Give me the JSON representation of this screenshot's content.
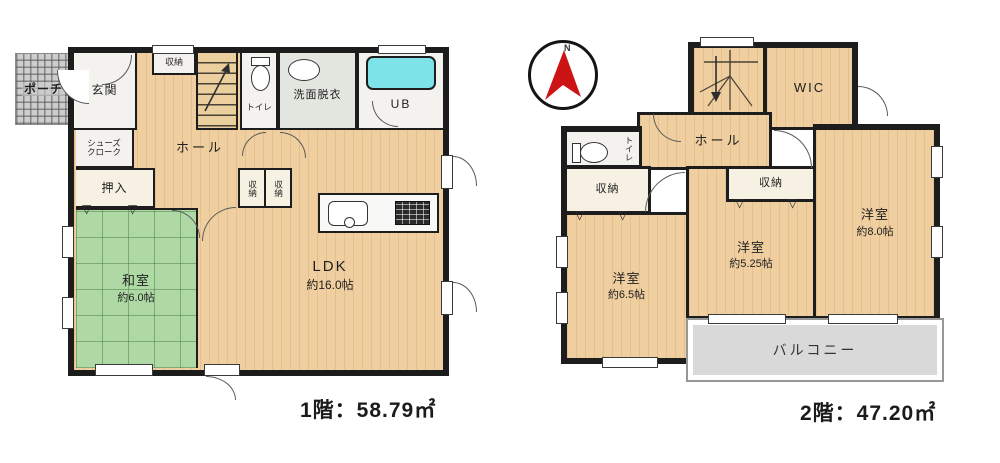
{
  "floor1": {
    "caption": "1階：58.79㎡",
    "porch": "ポーチ",
    "entrance": "玄関",
    "closet_top": "収納",
    "toilet": "トイレ",
    "washroom": "洗面脱衣",
    "bath": "UB",
    "hall": "ホール",
    "shoe_cloak_line1": "シューズ",
    "shoe_cloak_line2": "クローク",
    "oshiire": "押入",
    "tatami_name": "和室",
    "tatami_size": "約6.0帖",
    "closet_mid_left": "収納",
    "closet_mid_right": "収納",
    "ldk_name": "LDK",
    "ldk_size": "約16.0帖"
  },
  "floor2": {
    "caption": "2階：47.20㎡",
    "compass_north": "N",
    "wic": "WIC",
    "hall": "ホール",
    "toilet": "トイレ",
    "closet_left": "収納",
    "closet_mid": "収納",
    "bedroom1_name": "洋室",
    "bedroom1_size": "約6.5帖",
    "bedroom2_name": "洋室",
    "bedroom2_size": "約5.25帖",
    "bedroom3_name": "洋室",
    "bedroom3_size": "約8.0帖",
    "balcony": "バルコニー"
  },
  "glyphs": {
    "closet_marker": "▽"
  },
  "colors": {
    "wall": "#1c1c1c",
    "wood_floor": "#efce9f",
    "tatami": "#aed9a5",
    "bathtub": "#7ee3e9",
    "balcony": "#d9d9d9",
    "compass_arrow": "#cd1414"
  }
}
